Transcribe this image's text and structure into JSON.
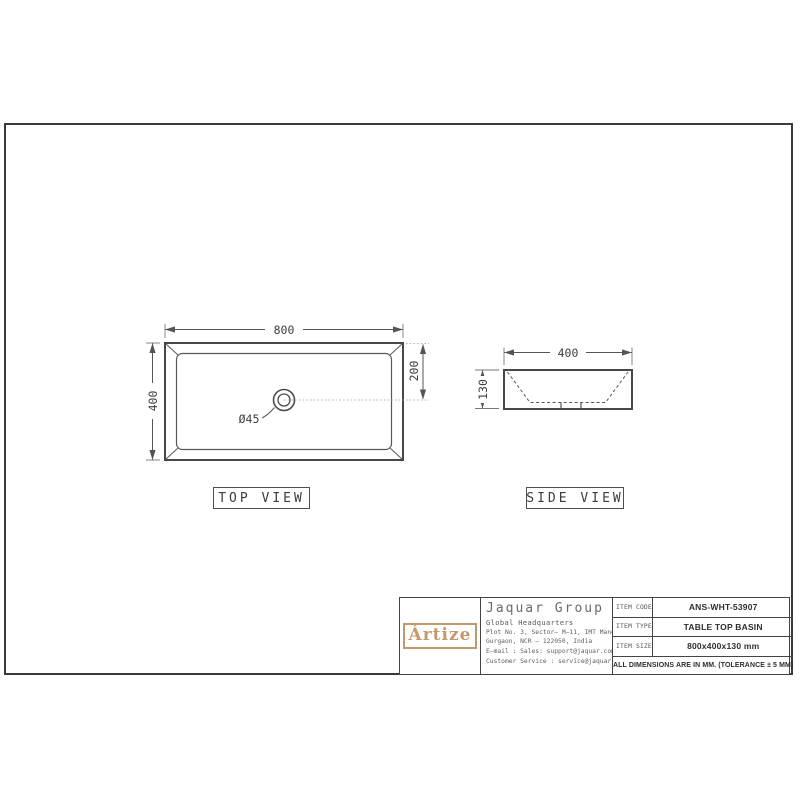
{
  "colors": {
    "line": "#4a4a4a",
    "dim_line": "#5a5a5a",
    "gold": "#c49a6c"
  },
  "top_view": {
    "label": "TOP VIEW",
    "dim_width": "800",
    "dim_height": "400",
    "dim_drain_offset": "200",
    "dim_drain_diameter": "Ø45"
  },
  "side_view": {
    "label": "SIDE VIEW",
    "dim_width": "400",
    "dim_height": "130"
  },
  "title_block": {
    "logo_text": "Ártize",
    "company": "Jaquar Group",
    "hq": "Global Headquarters",
    "address1": "Plot No. 3, Sector– M–11, IMT Manesar",
    "address2": "Gurgaon, NCR – 122050, India",
    "email": "E–mail : Sales: support@jaquar.com",
    "customer_service": "Customer Service : service@jaquar.com",
    "rows": [
      {
        "label": "ITEM CODE",
        "value": "ANS-WHT-53907"
      },
      {
        "label": "ITEM TYPE",
        "value": "TABLE TOP BASIN"
      },
      {
        "label": "ITEM SIZE",
        "value": "800x400x130 mm"
      }
    ],
    "note": "ALL DIMENSIONS ARE IN MM. (TOLERANCE ± 5 MM)"
  }
}
